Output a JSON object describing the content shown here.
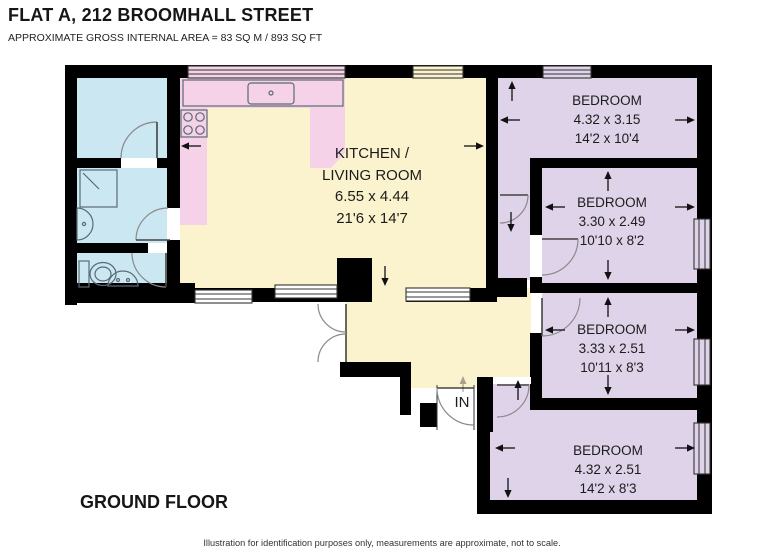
{
  "header": {
    "title": "FLAT A, 212 BROOMHALL STREET",
    "subtitle": "APPROXIMATE GROSS INTERNAL AREA = 83 SQ M / 893 SQ FT"
  },
  "plan": {
    "floor_label": "GROUND FLOOR",
    "entrance_label": "IN",
    "rooms": {
      "kitchen_living": {
        "label": [
          "KITCHEN /",
          "LIVING ROOM"
        ],
        "metric": "6.55 x 4.44",
        "imperial": "21'6 x 14'7"
      },
      "bedroom_1": {
        "label": "BEDROOM",
        "metric": "4.32 x 3.15",
        "imperial": "14'2 x 10'4"
      },
      "bedroom_2": {
        "label": "BEDROOM",
        "metric": "3.30 x 2.49",
        "imperial": "10'10 x 8'2"
      },
      "bedroom_3": {
        "label": "BEDROOM",
        "metric": "3.33 x 2.51",
        "imperial": "10'11 x 8'3"
      },
      "bedroom_4": {
        "label": "BEDROOM",
        "metric": "4.32 x 2.51",
        "imperial": "14'2 x 8'3"
      }
    },
    "colors": {
      "wall": "#000000",
      "bathroom": "#cbe7f2",
      "kitchen": "#f6d2e8",
      "living": "#fbf3cd",
      "bedroom": "#ded3e8"
    }
  },
  "footer": {
    "disclaimer": "Illustration for identification purposes only, measurements are approximate, not to scale."
  }
}
